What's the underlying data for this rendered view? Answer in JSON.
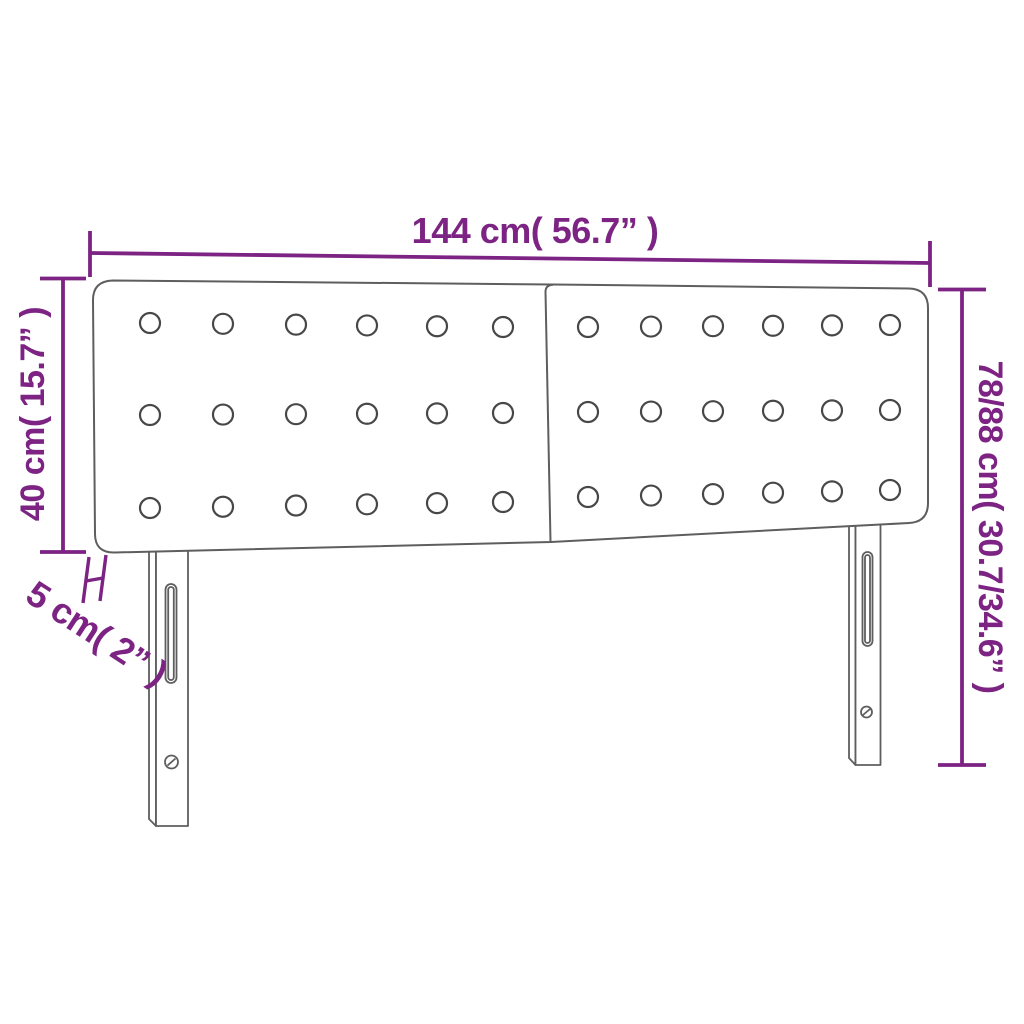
{
  "page": {
    "background": "#ffffff"
  },
  "colors": {
    "dimension_accent": "#7c2383",
    "drawing_line": "#5e5e5e"
  },
  "diagram": {
    "title": "Headboard dimension diagram",
    "product": "Upholstered double-panel headboard with tufted buttons and two slotted legs",
    "dimensions": {
      "width": "144 cm( 56.7” )",
      "height_panel": "40 cm( 15.7” )",
      "height_total": "78/88 cm( 30.7/34.6” )",
      "thickness": "5 cm( 2” )"
    },
    "tufting": {
      "panels": 2,
      "rows_per_panel": 3,
      "buttons_per_row": 6,
      "total_buttons": 36
    }
  }
}
